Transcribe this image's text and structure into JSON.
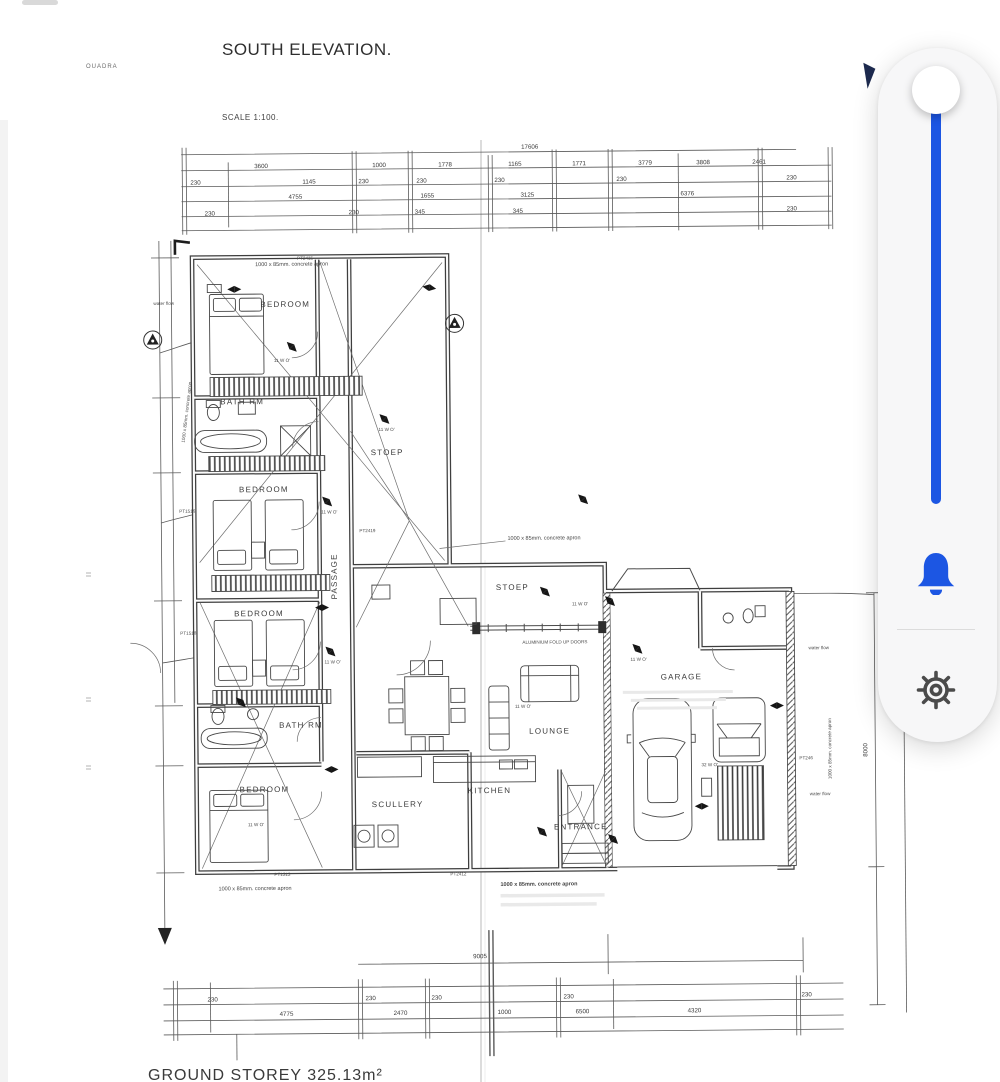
{
  "title_block": {
    "title": "SOUTH ELEVATION.",
    "watermark": "OUADRA",
    "scale": "SCALE 1:100.",
    "footer": "GROUND STOREY 325.13m²"
  },
  "plan": {
    "rooms": {
      "bedroom_1": "BEDROOM",
      "bath_1": "BATH RM",
      "bedroom_2": "BEDROOM",
      "bedroom_3": "BEDROOM",
      "bath_2": "BATH RM",
      "bedroom_4": "BEDROOM",
      "passage": "PASSAGE",
      "stoep_upper": "STOEP",
      "stoep_lower": "STOEP",
      "lounge": "LOUNGE",
      "kitchen": "KITCHEN",
      "scullery": "SCULLERY",
      "entrance": "ENTRANCE",
      "garage": "GARAGE"
    },
    "notes": {
      "apron": "1000 x 85mm. concrete apron",
      "fold_doors": "ALUMINIUM FOLD UP DOORS",
      "water_flow": "water flow",
      "window_mark": "11 W O'",
      "window_mark_garage": "32 W O'"
    },
    "pt": {
      "pt2415": "PT2415",
      "pt1516": "PT1516",
      "pt1518": "PT1518",
      "pt2419": "PT2419",
      "pt1313": "PT1313",
      "pt2412": "PT2412",
      "pt246": "PT246"
    },
    "dimensions": {
      "top_total": "17606",
      "top_row1": [
        "3600",
        "1000",
        "1778",
        "1165",
        "1771",
        "3779",
        "3808",
        "2461"
      ],
      "top_row1_small": [
        "230",
        "1145",
        "230",
        "230",
        "230",
        "230",
        "230"
      ],
      "top_row2": [
        "4755",
        "1655",
        "3125",
        "6376"
      ],
      "top_row2_small": [
        "230",
        "230",
        "345",
        "345",
        "230"
      ],
      "bottom_span": "9005",
      "bottom_row": [
        "4775",
        "2470",
        "1000",
        "6500",
        "4320"
      ],
      "bottom_row_small": [
        "230",
        "230",
        "230",
        "230",
        "230"
      ],
      "right_height": "8000"
    }
  },
  "side_panel": {
    "colors": {
      "accent": "#1c56e3",
      "panel_bg": "#f7f7f8",
      "gear": "#4b4b4b"
    },
    "icons": {
      "slider": "vertical-slider",
      "bell": "bell-icon",
      "settings": "gear-icon"
    }
  }
}
